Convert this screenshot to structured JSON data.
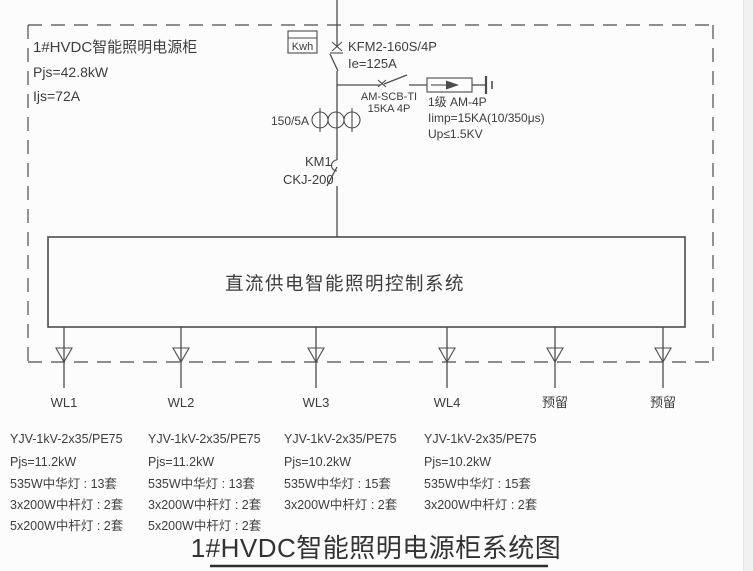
{
  "cabinet": {
    "name": "1#HVDC智能照明电源柜",
    "pjs": "Pjs=42.8kW",
    "ijs": "Ijs=72A"
  },
  "meter": {
    "label": "Kwh"
  },
  "main_breaker": {
    "model": "KFM2-160S/4P",
    "current": "Ie=125A"
  },
  "spd_branch": {
    "switch_model": "AM-SCB-TI",
    "switch_rating": "15KA 4P",
    "spd_class": "1级 AM-4P",
    "spd_iimp": "Iimp=15KA(10/350μs)",
    "spd_up": "Up≤1.5KV"
  },
  "ct": {
    "ratio": "150/5A"
  },
  "contactor": {
    "name": "KM1",
    "model": "CKJ-200"
  },
  "control_box": {
    "label": "直流供电智能照明控制系统"
  },
  "outputs": [
    {
      "label": "WL1"
    },
    {
      "label": "WL2"
    },
    {
      "label": "WL3"
    },
    {
      "label": "WL4"
    },
    {
      "label": "预留"
    },
    {
      "label": "预留"
    }
  ],
  "circuits": [
    {
      "cable": "YJV-1kV-2x35/PE75",
      "power": "Pjs=11.2kW",
      "loads": [
        "535W中华灯 : 13套",
        "3x200W中杆灯 : 2套",
        "5x200W中杆灯 : 2套"
      ]
    },
    {
      "cable": "YJV-1kV-2x35/PE75",
      "power": "Pjs=11.2kW",
      "loads": [
        "535W中华灯 : 13套",
        "3x200W中杆灯 : 2套",
        "5x200W中杆灯 : 2套"
      ]
    },
    {
      "cable": "YJV-1kV-2x35/PE75",
      "power": "Pjs=10.2kW",
      "loads": [
        "535W中华灯 : 15套",
        "3x200W中杆灯 : 2套"
      ]
    },
    {
      "cable": "YJV-1kV-2x35/PE75",
      "power": "Pjs=10.2kW",
      "loads": [
        "535W中华灯 : 15套",
        "3x200W中杆灯 : 2套"
      ]
    }
  ],
  "title": "1#HVDC智能照明电源柜系统图"
}
